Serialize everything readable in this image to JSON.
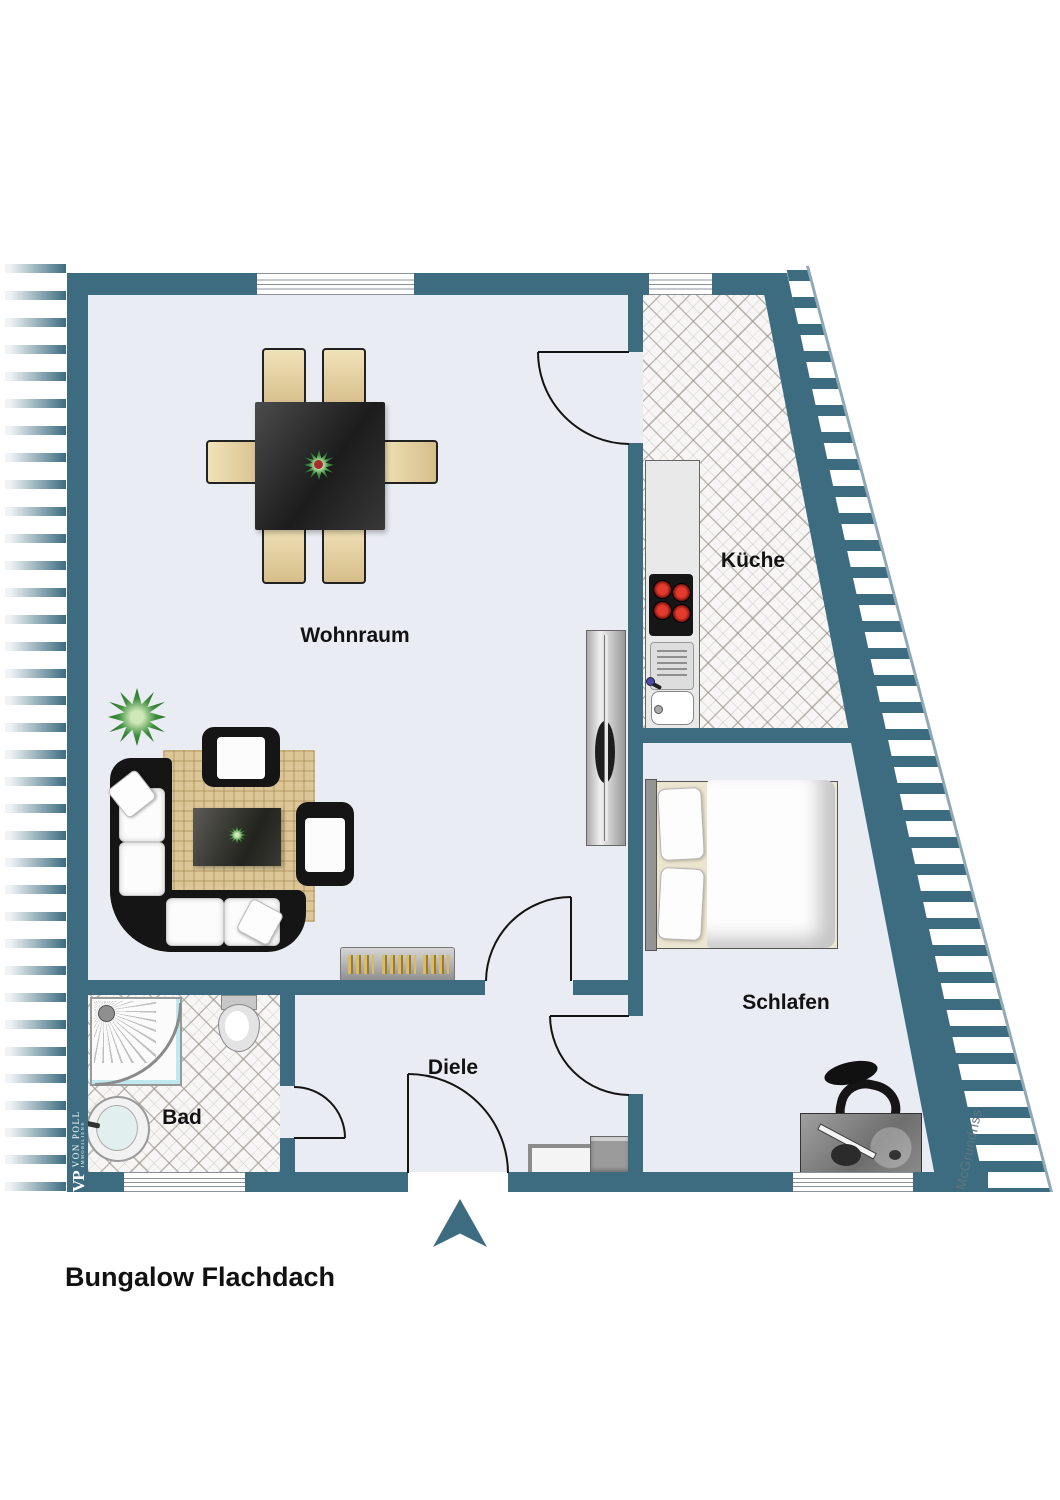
{
  "title": "Bungalow Flachdach",
  "rooms": {
    "wohnraum": {
      "label": "Wohnraum"
    },
    "kueche": {
      "label": "Küche"
    },
    "schlafen": {
      "label": "Schlafen"
    },
    "bad": {
      "label": "Bad"
    },
    "diele": {
      "label": "Diele"
    }
  },
  "branding": {
    "logo_initials": "VP",
    "logo_name": "VON POLL",
    "logo_subtitle": "IMMOBILIEN®",
    "watermark": "McGrundriss"
  },
  "colors": {
    "wall": "#3d6c81",
    "floor": "#e9ecf2",
    "tile": "#f7f6f4",
    "burner_red": "#e23a2c",
    "rug_beige": "#dcc697"
  }
}
